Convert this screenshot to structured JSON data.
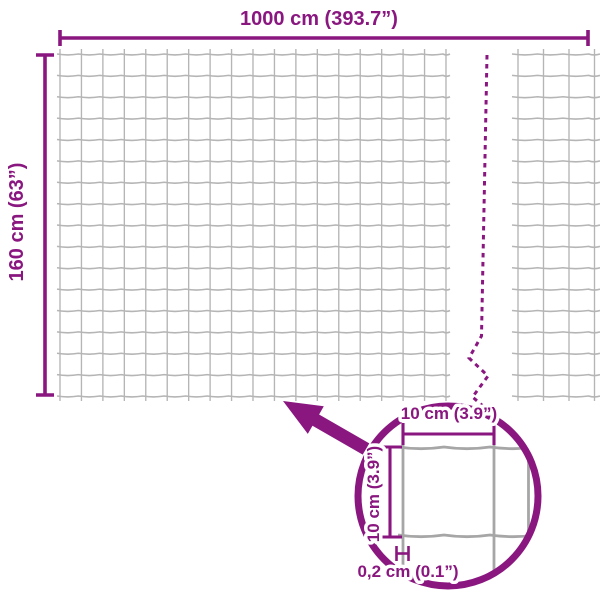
{
  "colors": {
    "accent_purple": "#8A1780",
    "mesh_gray": "#b5b5b5",
    "detail_wire_gray": "#a6a6a6",
    "background": "#ffffff"
  },
  "labels": {
    "total_width": "1000 cm (393.7”)",
    "total_height": "160 cm (63”)",
    "detail_mesh_width": "10 cm (3.9”)",
    "detail_mesh_height": "10 cm (3.9”)",
    "detail_wire_thickness": "0,2 cm (0.1”)"
  }
}
